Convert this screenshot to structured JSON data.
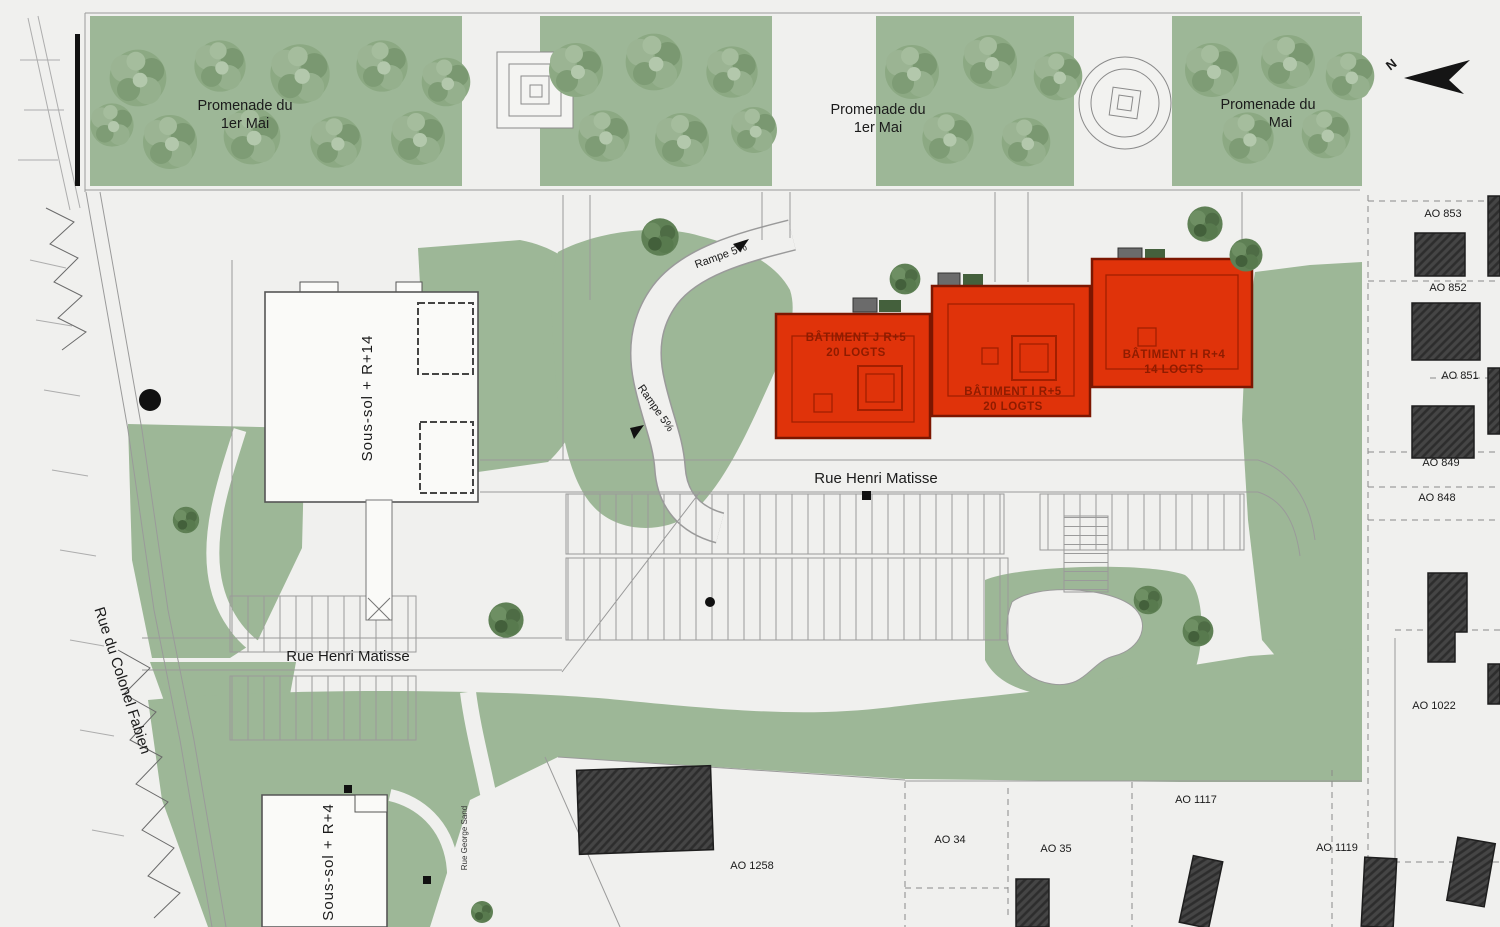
{
  "plan": {
    "north_label": "N",
    "promenade": {
      "line1": "Promenade du",
      "line2": "1er Mai"
    },
    "ramp_label": "Rampe 5%",
    "streets": {
      "henri_matisse": "Rue Henri Matisse",
      "colonel_fabien": "Rue du Colonel Fabien",
      "george_sand": "Rue George Sand"
    },
    "existing_buildings": {
      "tower": "Sous-sol + R+14",
      "low_block": "Sous-sol + R+4"
    },
    "batiments": [
      {
        "name": "BÂTIMENT J R+5",
        "logts": "20 LOGTS"
      },
      {
        "name": "BÂTIMENT I R+5",
        "logts": "20 LOGTS"
      },
      {
        "name": "BÂTIMENT H R+4",
        "logts": "14 LOGTS"
      }
    ],
    "parcels": {
      "ao853": "AO 853",
      "ao852": "AO 852",
      "ao851": "AO 851",
      "ao849": "AO 849",
      "ao848": "AO 848",
      "ao1022": "AO 1022",
      "ao1117": "AO 1117",
      "ao1119": "AO 1119",
      "ao34": "AO 34",
      "ao35": "AO 35",
      "ao1258": "AO 1258"
    },
    "colors": {
      "background": "#f0f0ee",
      "park_green": "#9db797",
      "tree_green": "#8ca983",
      "highlight_red": "#e0330a",
      "red_text": "#8f1c00",
      "dark_building": "#454545",
      "line_gray": "#9a9a9a"
    }
  }
}
